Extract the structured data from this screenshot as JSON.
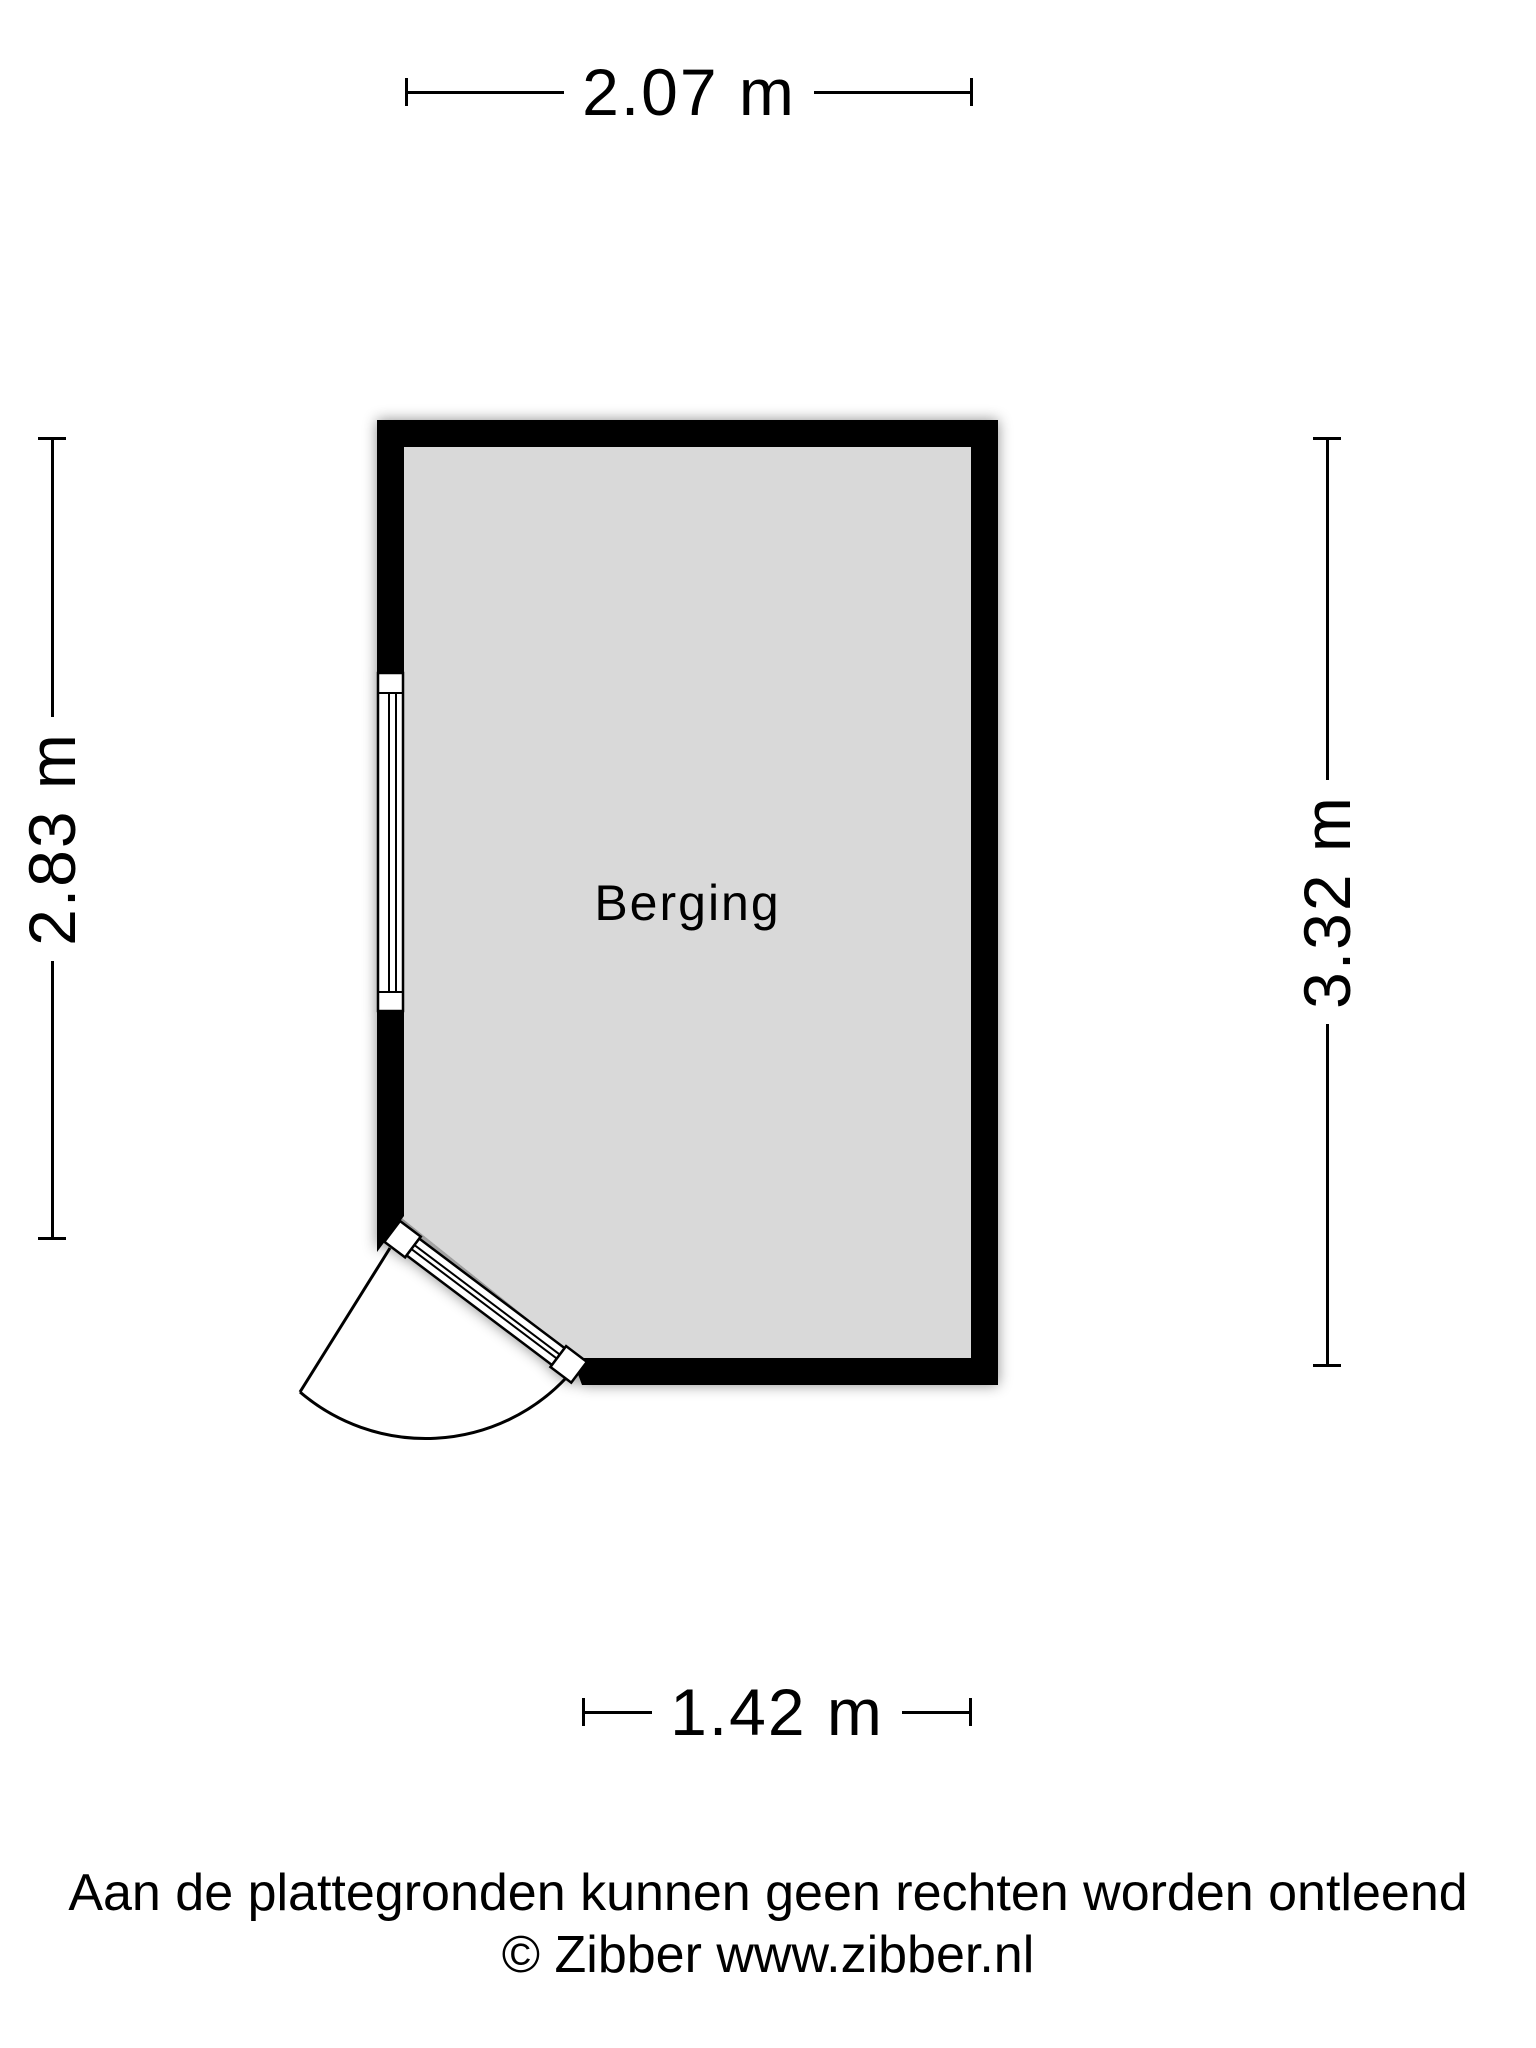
{
  "floorplan": {
    "room": {
      "label": "Berging"
    },
    "dimensions": {
      "top": "2.07 m",
      "left": "2.83 m",
      "right": "3.32 m",
      "bottom": "1.42 m"
    }
  },
  "footer": {
    "disclaimer": "Aan de plattegronden kunnen geen rechten worden ontleend",
    "copyright": "© Zibber www.zibber.nl"
  },
  "colors": {
    "wall": "#000000",
    "floor": "#d9d9d9",
    "line": "#000000",
    "background": "#ffffff"
  }
}
